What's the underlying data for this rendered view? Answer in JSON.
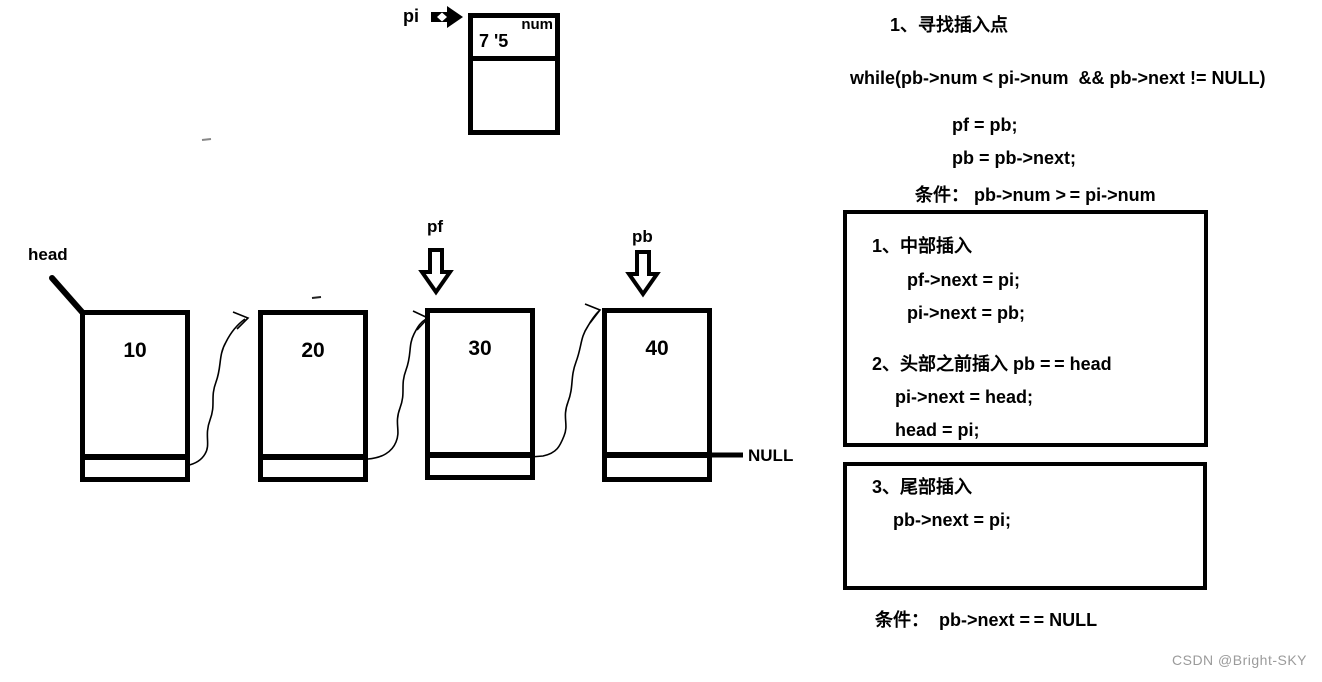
{
  "pi_node": {
    "label": "pi",
    "field_label": "num",
    "value": "7 '5"
  },
  "list": {
    "head_label": "head",
    "pf_label": "pf",
    "pb_label": "pb",
    "null_label": "NULL",
    "nodes": [
      {
        "value": "10"
      },
      {
        "value": "20"
      },
      {
        "value": "30"
      },
      {
        "value": "40"
      }
    ]
  },
  "steps": {
    "find_title": "1、寻找插入点",
    "while_line": "while(pb->num < pi->num  && pb->next != NULL)",
    "loop_line1": "pf = pb;",
    "loop_line2": "pb = pb->next;",
    "condition1": "条件： pb->num > = pi->num",
    "case_middle_title": "1、中部插入",
    "case_middle_line1": "pf->next = pi;",
    "case_middle_line2": "pi->next = pb;",
    "case_head_title": "2、头部之前插入 pb = = head",
    "case_head_line1": "pi->next = head;",
    "case_head_line2": "head = pi;",
    "case_tail_title": "3、尾部插入",
    "case_tail_line1": "pb->next = pi;",
    "condition2": "条件：  pb->next = = NULL"
  },
  "watermark": "CSDN @Bright-SKY",
  "colors": {
    "ink": "#000000",
    "watermark": "#9b9b9b"
  }
}
